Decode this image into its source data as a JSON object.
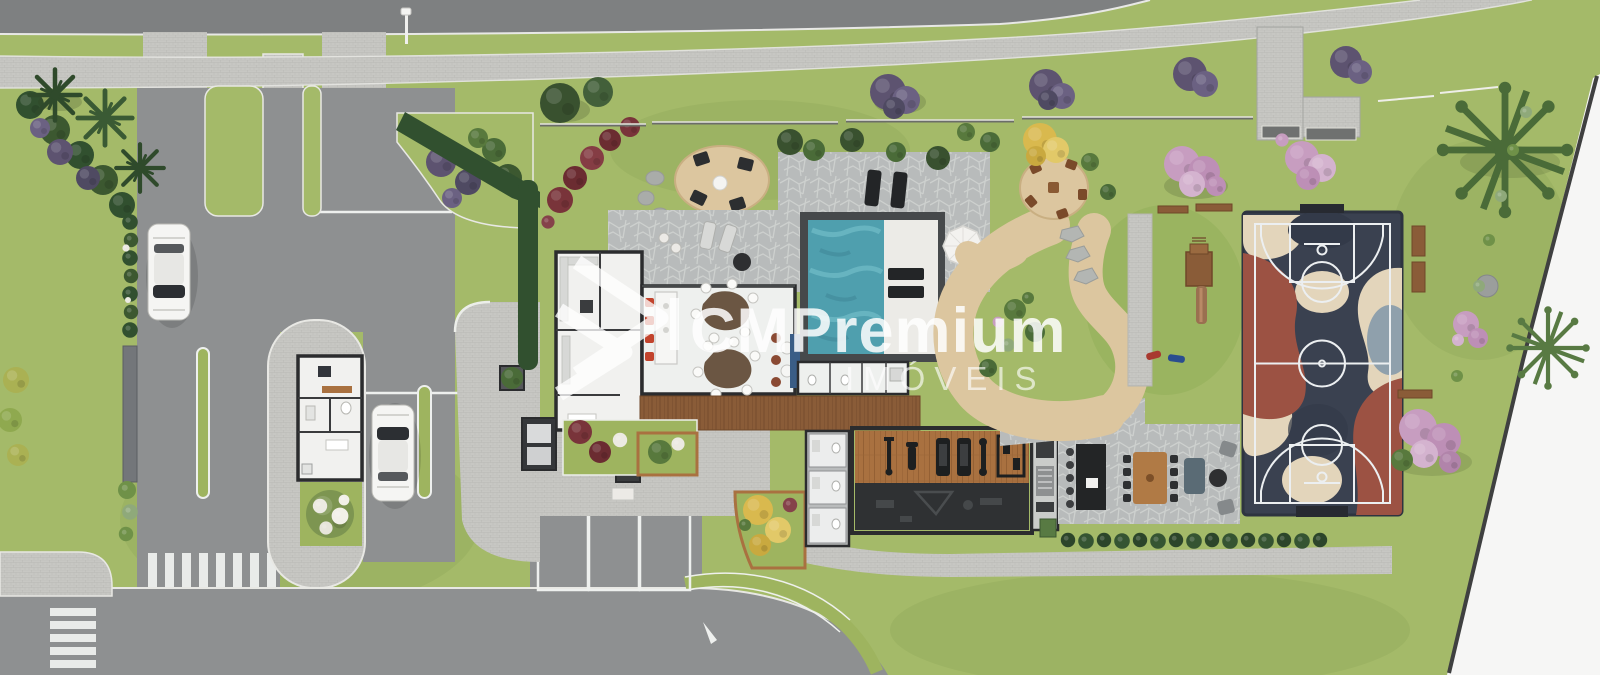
{
  "image": {
    "kind": "aerial site plan rendering",
    "width": 1600,
    "height": 675
  },
  "watermark": {
    "brand": "CMPremium",
    "subtitle": "IMÓVEIS",
    "logo": "cm-chevron-logo-icon",
    "color": "#ffffff"
  },
  "palette": {
    "grass": "#a4ba69",
    "grass_dark": "#84a04f",
    "road_top": "#7e8081",
    "asphalt": "#8e9091",
    "paver": "#c7c7c3",
    "flagstone": "#b8bbbb",
    "sand": "#dcc69f",
    "sand_edge": "#c9af82",
    "pool_water": "#4f9fae",
    "pool_deck": "#ecebe7",
    "wall_dark": "#2b2c2e",
    "floor_white": "#f1f1ef",
    "wood_deck": "#8a5c38",
    "gym_wood": "#a97140",
    "gym_dark": "#2f3133",
    "court_base": "#3a4150",
    "court_red": "#9c5243",
    "court_beige": "#e3d5bb",
    "court_gray": "#8fa0ac",
    "court_line": "#eceff1",
    "tree_green": "#4a6b38",
    "hedge": "#31502f",
    "shrub_purple": "#5d5370",
    "shrub_red": "#79343a",
    "tree_pink": "#c79dc0",
    "tree_yellow": "#d9b94e",
    "car_body": "#f5f5f3",
    "marking_white": "#eef0ee",
    "outside": "#f6f6f5"
  },
  "scene": {
    "parked_car_count": 2,
    "visitor_parking_space_count": 3,
    "crosswalk_count": 2,
    "round_patio_count": 2,
    "amenities": [
      "entrance gatehouse",
      "visitor parking",
      "clubhouse",
      "gourmet kitchen",
      "dining hall",
      "stone terrace",
      "swimming pool",
      "pool deck",
      "wood deck",
      "round lounge patio",
      "round picnic patio",
      "fitness room",
      "restrooms",
      "barbecue terrace",
      "basketball court",
      "playground",
      "garden paths",
      "lawns",
      "boundary wall"
    ]
  }
}
